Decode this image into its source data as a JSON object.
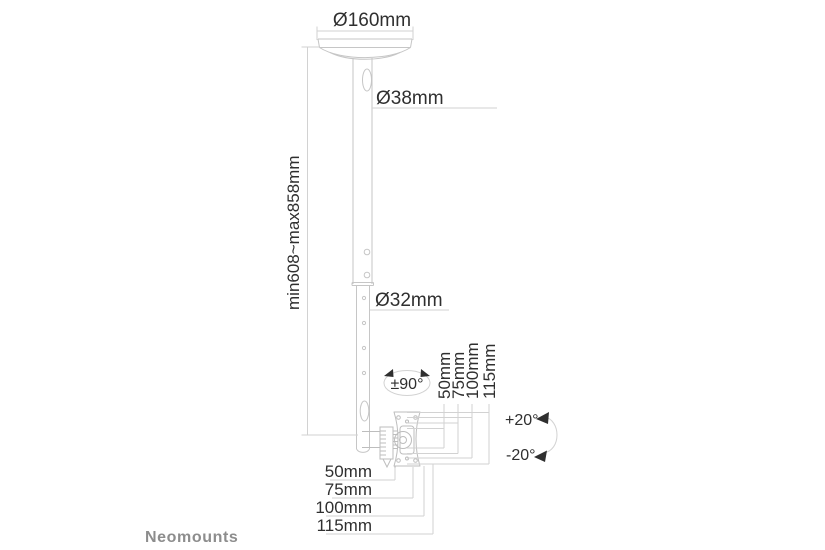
{
  "title": "Ceiling mount dimension diagram",
  "brand": "Neomounts",
  "labels": {
    "plate_diameter": "Ø160mm",
    "upper_pole_diameter": "Ø38mm",
    "lower_pole_diameter": "Ø32mm",
    "height_range": "min608~max858mm",
    "rotation": "±90°",
    "tilt_up": "+20°",
    "tilt_down": "-20°"
  },
  "vesa_vertical_labels": [
    "50mm",
    "75mm",
    "100mm",
    "115mm"
  ],
  "vesa_horizontal_labels": [
    "50mm",
    "75mm",
    "100mm",
    "115mm"
  ],
  "colors": {
    "background": "#ffffff",
    "drawing_line": "#c6c6c6",
    "dimension_line": "#d2d2d2",
    "text": "#2f2f2f",
    "brand_text": "#8d8d8d"
  }
}
